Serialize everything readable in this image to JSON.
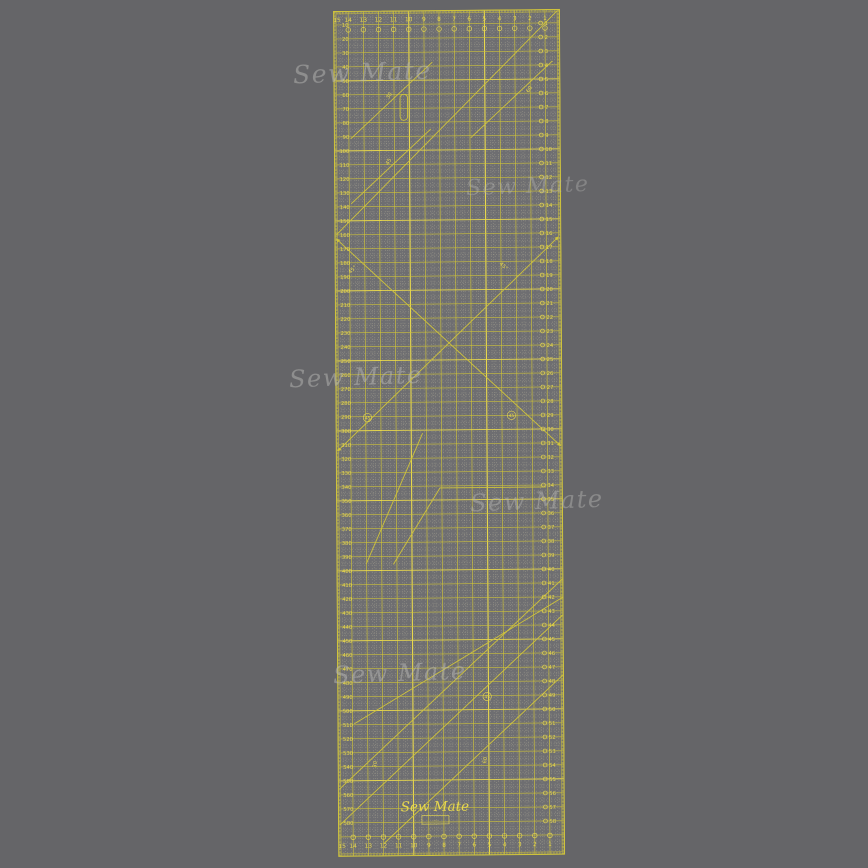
{
  "image": {
    "background_color": "#656568"
  },
  "watermarks": {
    "items": [
      "Sew Mate",
      "Sew Mate",
      "Sew Mate",
      "Sew Mate",
      "Sew Mate"
    ]
  },
  "ruler": {
    "brand": "Sew Mate",
    "brand_box_text": "·····",
    "brand_footnote": "· · · · · · · ·",
    "colors": {
      "body": "#6e6e71",
      "line": "#cfc33b",
      "bright": "#e8d84d",
      "pale": "#c6c1a4"
    },
    "top_scale": {
      "unit": "cm",
      "labels": [
        15,
        14,
        13,
        12,
        11,
        10,
        9,
        8,
        7,
        6,
        5,
        4,
        3,
        2,
        1
      ]
    },
    "bottom_scale": {
      "unit": "cm",
      "labels": [
        15,
        14,
        13,
        12,
        11,
        10,
        9,
        8,
        7,
        6,
        5,
        4,
        3,
        2,
        1
      ]
    },
    "left_scale": {
      "unit": "mm",
      "start": 10,
      "end": 580,
      "step": 10
    },
    "right_scale": {
      "unit": "cm",
      "start": 1,
      "end": 58,
      "step": 1
    },
    "angle_labels": {
      "deg45": "45°",
      "n45": "45",
      "n30": "30",
      "n60": "60"
    }
  }
}
